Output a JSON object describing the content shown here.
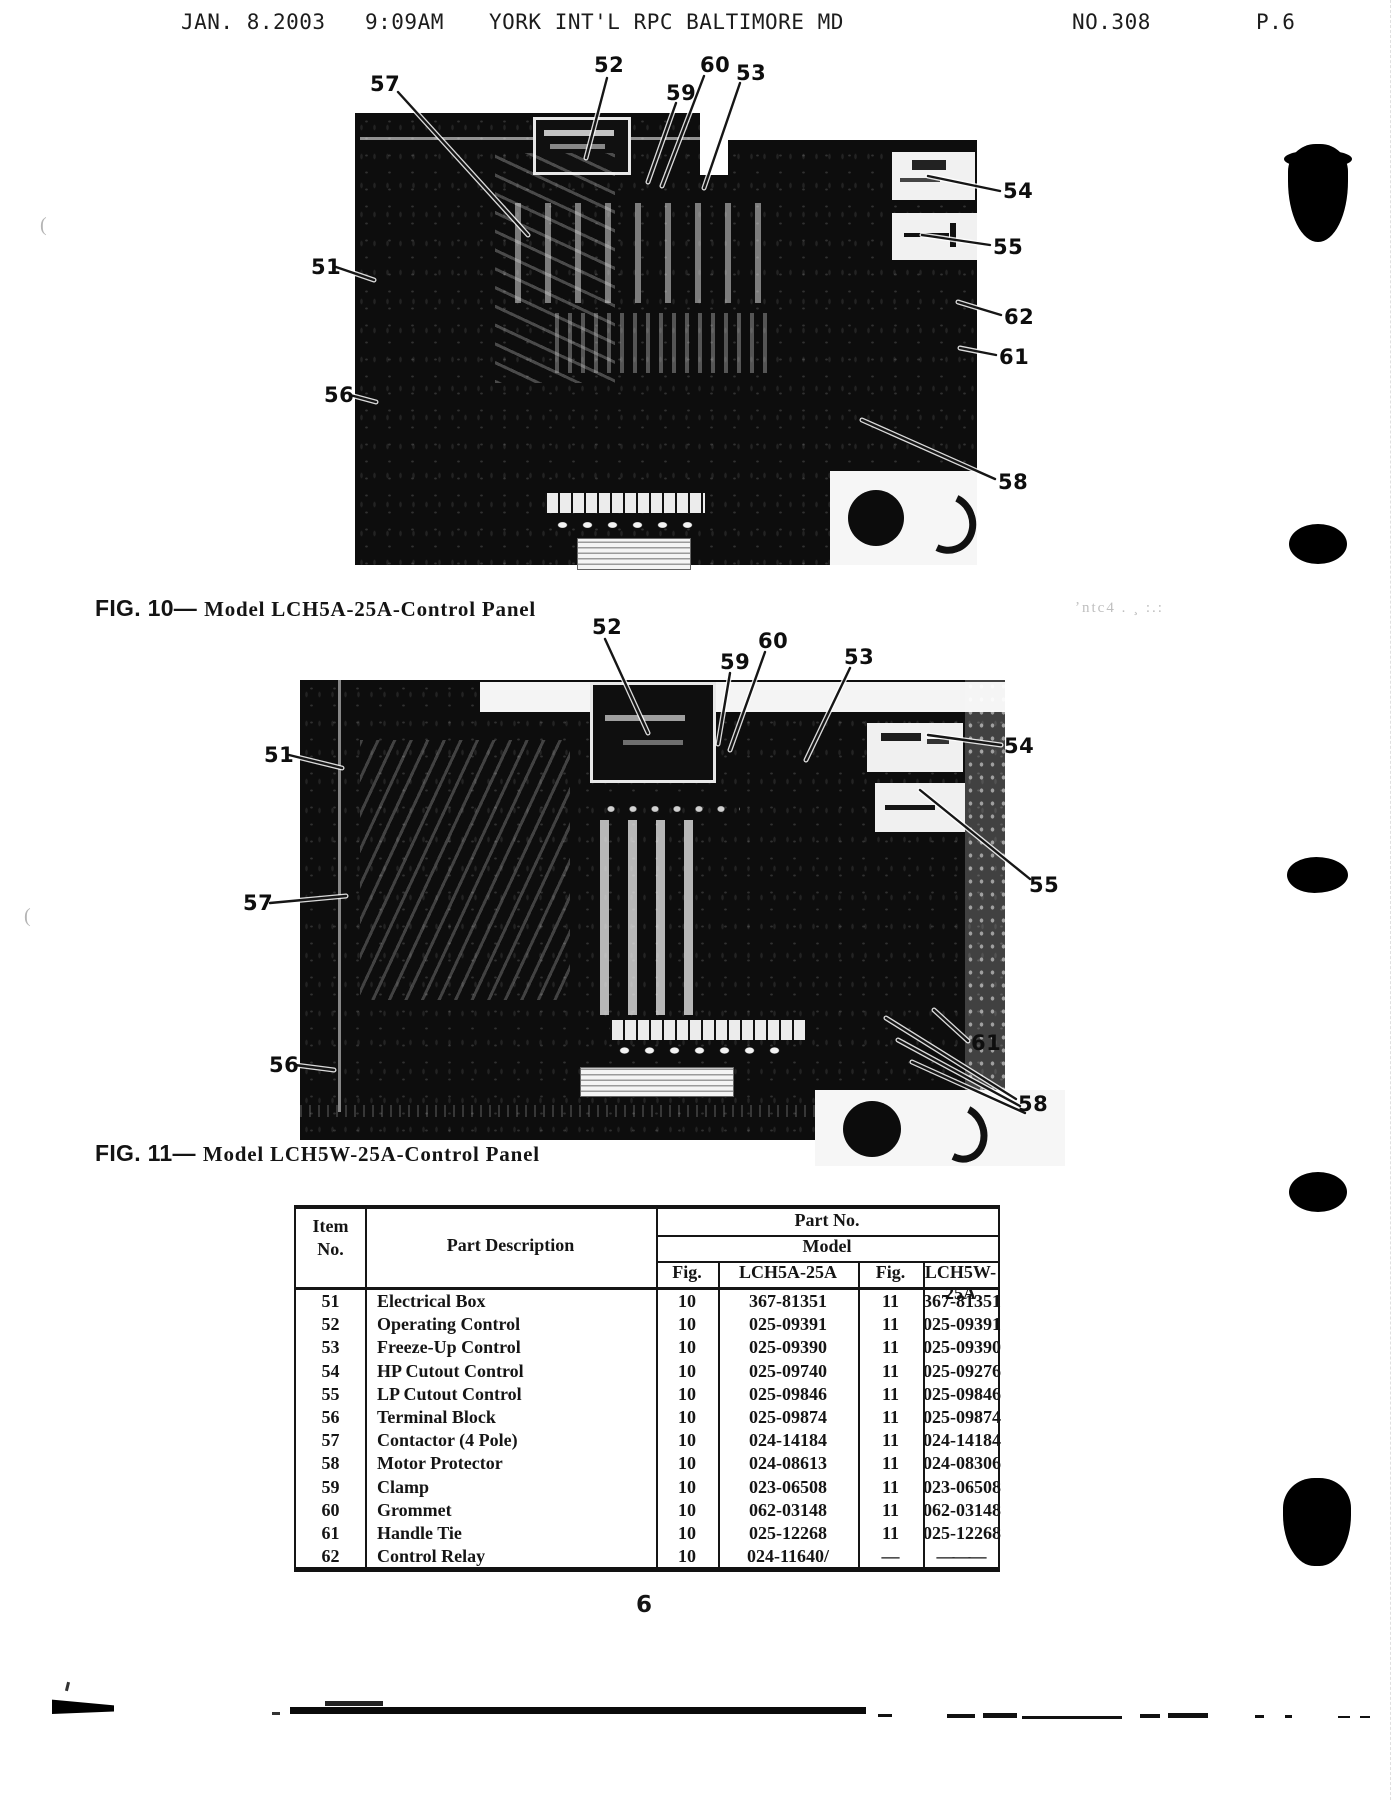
{
  "page": {
    "number": "6"
  },
  "fax_header": {
    "datetime": "JAN. 8.2003   9:09AM",
    "station": "YORK INT'L RPC BALTIMORE MD",
    "no": "NO.308",
    "page": "P.6"
  },
  "margin_smudge": "ʼntc4 . ¸ :.:",
  "margin_marks": [
    {
      "text": "(",
      "x": 40,
      "y": 214
    },
    {
      "text": "(",
      "x": 24,
      "y": 905
    }
  ],
  "figures": [
    {
      "caption": "FIG. 10—",
      "title": "Model LCH5A-25A-Control Panel",
      "callouts": [
        {
          "label": "57",
          "lx": 370,
          "ly": 72,
          "lines": [
            [
              398,
              92,
              528,
              235
            ]
          ]
        },
        {
          "label": "52",
          "lx": 594,
          "ly": 53,
          "lines": [
            [
              607,
              78,
              586,
              158
            ]
          ]
        },
        {
          "label": "59",
          "lx": 666,
          "ly": 81,
          "lines": [
            [
              676,
              103,
              648,
              182
            ]
          ]
        },
        {
          "label": "60",
          "lx": 700,
          "ly": 53,
          "lines": [
            [
              704,
              76,
              662,
              186
            ]
          ]
        },
        {
          "label": "53",
          "lx": 736,
          "ly": 61,
          "lines": [
            [
              740,
              83,
              704,
              188
            ]
          ]
        },
        {
          "label": "54",
          "lx": 1003,
          "ly": 179,
          "lines": [
            [
              1000,
              191,
              928,
              176
            ]
          ]
        },
        {
          "label": "55",
          "lx": 993,
          "ly": 235,
          "lines": [
            [
              990,
              245,
              922,
              235
            ]
          ]
        },
        {
          "label": "62",
          "lx": 1004,
          "ly": 305,
          "lines": [
            [
              1001,
              315,
              958,
              302
            ]
          ]
        },
        {
          "label": "61",
          "lx": 999,
          "ly": 345,
          "lines": [
            [
              996,
              355,
              960,
              348
            ]
          ]
        },
        {
          "label": "58",
          "lx": 998,
          "ly": 470,
          "lines": [
            [
              995,
              479,
              862,
              420
            ]
          ]
        },
        {
          "label": "51",
          "lx": 311,
          "ly": 255,
          "lines": [
            [
              336,
              267,
              374,
              280
            ]
          ]
        },
        {
          "label": "56",
          "lx": 324,
          "ly": 383,
          "lines": [
            [
              350,
              395,
              376,
              402
            ]
          ]
        }
      ]
    },
    {
      "caption": "FIG. 11—",
      "title": "Model LCH5W-25A-Control Panel",
      "callouts": [
        {
          "label": "52",
          "lx": 592,
          "ly": 615,
          "lines": [
            [
              605,
              639,
              648,
              733
            ]
          ]
        },
        {
          "label": "59",
          "lx": 720,
          "ly": 650,
          "lines": [
            [
              730,
              673,
              718,
              744
            ]
          ]
        },
        {
          "label": "60",
          "lx": 758,
          "ly": 629,
          "lines": [
            [
              765,
              652,
              730,
              750
            ]
          ]
        },
        {
          "label": "53",
          "lx": 844,
          "ly": 645,
          "lines": [
            [
              850,
              668,
              806,
              760
            ]
          ]
        },
        {
          "label": "51",
          "lx": 264,
          "ly": 743,
          "lines": [
            [
              289,
              755,
              342,
              768
            ]
          ]
        },
        {
          "label": "57",
          "lx": 243,
          "ly": 891,
          "lines": [
            [
              270,
              903,
              346,
              896
            ]
          ]
        },
        {
          "label": "54",
          "lx": 1004,
          "ly": 734,
          "lines": [
            [
              1001,
              745,
              928,
              735
            ]
          ]
        },
        {
          "label": "55",
          "lx": 1029,
          "ly": 873,
          "lines": [
            [
              1030,
              879,
              920,
              790
            ]
          ]
        },
        {
          "label": "61",
          "lx": 971,
          "ly": 1031,
          "lines": [
            [
              968,
              1041,
              934,
              1010
            ]
          ]
        },
        {
          "label": "58",
          "lx": 1018,
          "ly": 1092,
          "lines": [
            [
              1016,
              1099,
              886,
              1018
            ],
            [
              1020,
              1106,
              898,
              1040
            ],
            [
              1025,
              1113,
              912,
              1062
            ]
          ]
        },
        {
          "label": "56",
          "lx": 269,
          "ly": 1053,
          "lines": [
            [
              295,
              1065,
              334,
              1070
            ]
          ]
        }
      ]
    }
  ],
  "table": {
    "header": {
      "item_line1": "Item",
      "item_line2": "No.",
      "desc": "Part Description",
      "part_no": "Part No.",
      "model": "Model",
      "fig_a": "Fig.",
      "model_a": "LCH5A-25A",
      "fig_w": "Fig.",
      "model_w": "LCH5W-25A"
    },
    "rows": [
      [
        "51",
        "Electrical Box",
        "10",
        "367-81351",
        "11",
        "367-81351"
      ],
      [
        "52",
        "Operating Control",
        "10",
        "025-09391",
        "11",
        "025-09391"
      ],
      [
        "53",
        "Freeze-Up Control",
        "10",
        "025-09390",
        "11",
        "025-09390"
      ],
      [
        "54",
        "HP Cutout Control",
        "10",
        "025-09740",
        "11",
        "025-09276"
      ],
      [
        "55",
        "LP Cutout Control",
        "10",
        "025-09846",
        "11",
        "025-09846"
      ],
      [
        "56",
        "Terminal Block",
        "10",
        "025-09874",
        "11",
        "025-09874"
      ],
      [
        "57",
        "Contactor (4 Pole)",
        "10",
        "024-14184",
        "11",
        "024-14184"
      ],
      [
        "58",
        "Motor Protector",
        "10",
        "024-08613",
        "11",
        "024-08306"
      ],
      [
        "59",
        "Clamp",
        "10",
        "023-06508",
        "11",
        "023-06508"
      ],
      [
        "60",
        "Grommet",
        "10",
        "062-03148",
        "11",
        "062-03148"
      ],
      [
        "61",
        "Handle Tie",
        "10",
        "025-12268",
        "11",
        "025-12268"
      ],
      [
        "62",
        "Control Relay",
        "10",
        "024-11640/",
        "—",
        "———"
      ]
    ]
  }
}
